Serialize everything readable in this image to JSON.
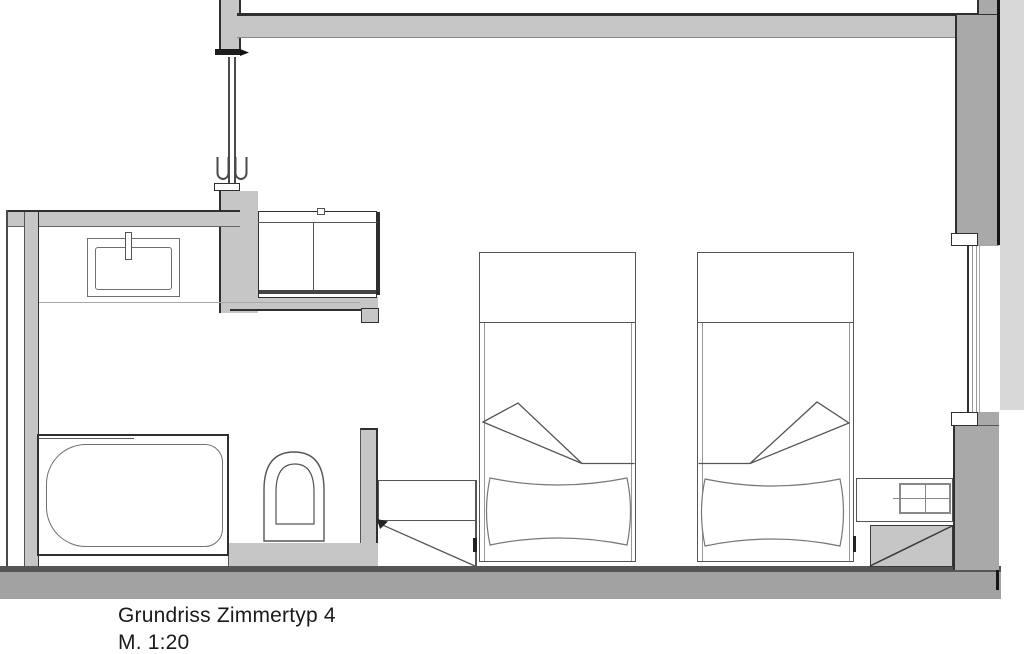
{
  "title_block": {
    "title": "Grundriss Zimmertyp 4",
    "scale": "M. 1:20"
  },
  "colors": {
    "wall": "#c6c6c6",
    "wall_dark": "#a9a9a9",
    "exterior": "#d8d8d8",
    "floor": "#a2a2a2",
    "ink": "#2f2f2f",
    "furn": "#6f6f6f",
    "paper": "#ffffff"
  },
  "rooms": {
    "bathroom": "bathroom",
    "bedroom": "bedroom",
    "entry": "entry"
  },
  "fixtures": {
    "washbasin": "washbasin",
    "faucet": "faucet",
    "bathtub": "bathtub",
    "toilet": "toilet",
    "entry_cabinet": "entry-cabinet",
    "entry_door": "entry-door",
    "bed_1": "bed-1",
    "bed_2": "bed-2",
    "pillow_1": "pillow-1",
    "pillow_2": "pillow-2",
    "blanket_fold_1": "blanket-fold-1",
    "blanket_fold_2": "blanket-fold-2",
    "luggage_bench": "luggage-bench",
    "nightstand": "nightstand",
    "luggage_rack": "luggage-rack",
    "window": "window"
  }
}
